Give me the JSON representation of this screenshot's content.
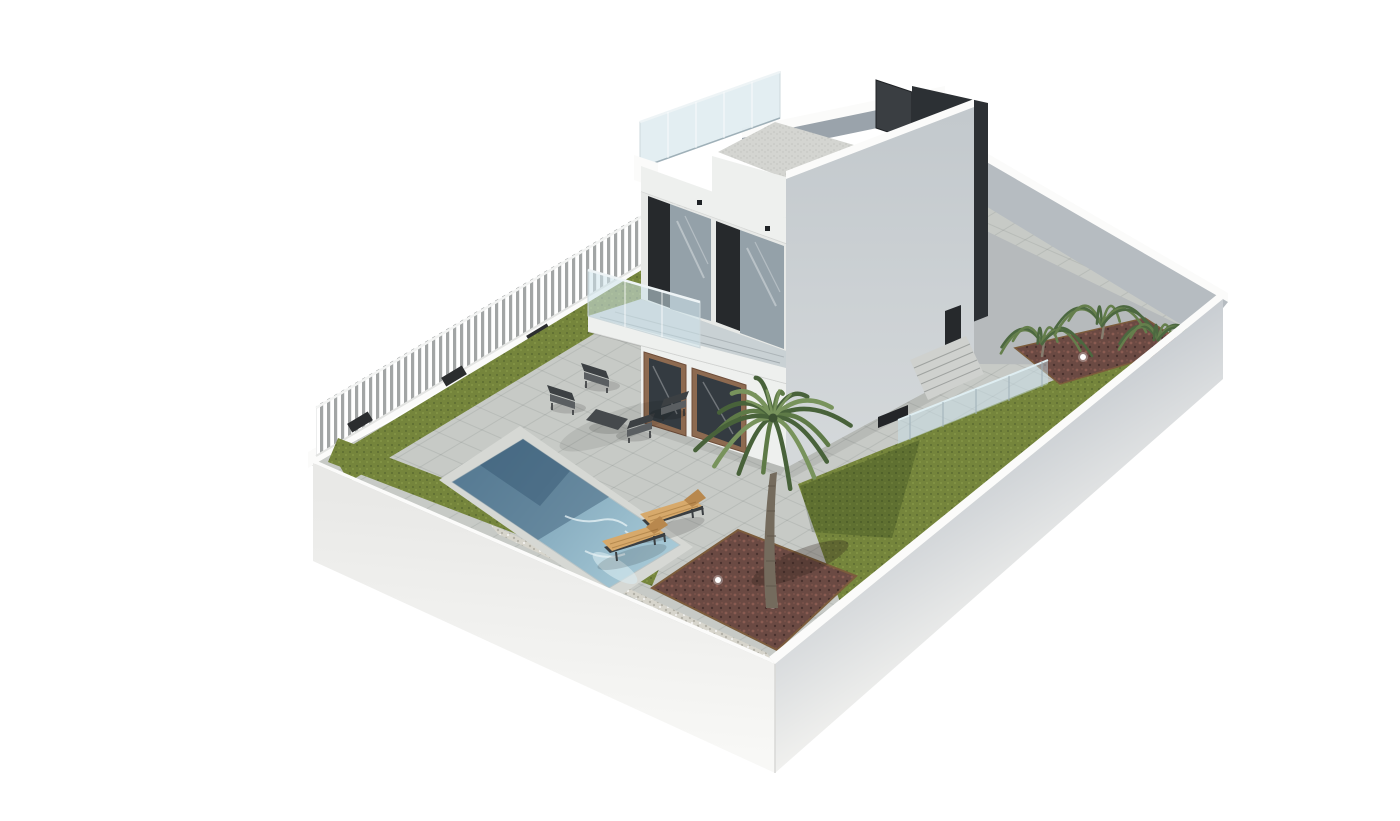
{
  "scene": {
    "title": "3D architectural render of a modern villa plot",
    "description": "Isometric 3D rendering on a white background: a modern two-storey white villa with dark window panels, roof terrace with glass balustrade and dark stair tower, front balcony, walled garden plot with white perimeter walls, slatted fence, olive-green lawns, grey paved terrace, rectangular swimming pool, two wooden sun loungers, dark outdoor lounge set, central palm tree in a red-brown mulch bed, rear shrubs and small garden spotlights.",
    "elements": [
      "perimeter-wall",
      "slat-fence",
      "lawn-strips",
      "right-lawn",
      "paved-terrace",
      "driveway",
      "swimming-pool",
      "pool-coping",
      "sun-loungers",
      "outdoor-sofa-set",
      "coffee-table",
      "villa-building",
      "roof-terrace",
      "glass-balustrade",
      "roof-deck",
      "stair-tower",
      "balcony",
      "balcony-glass-railing",
      "window-units",
      "entrance-doors",
      "exterior-stairs",
      "path-glass-railing",
      "palm-tree",
      "garden-shrubs",
      "mulch-beds",
      "gravel-strip",
      "garden-lights"
    ]
  },
  "palette": {
    "paving": "#c7cac6",
    "pavingLight": "#d6d8d4",
    "tileLine": "rgba(60,70,65,0.10)",
    "drive": "#b6babc",
    "driveLine": "rgba(50,60,60,0.18)",
    "lawn": "#75853c",
    "lawnDark": "#5c6c31",
    "lawnLight": "#8a9b49",
    "mulch": "#6b4a43",
    "mulchDot1": "#8a5c52",
    "mulchDot2": "#4a322e",
    "mulchDot3": "#7a524a",
    "mulchEdge": "#7c5c3c",
    "gravel": "#d7d5cc",
    "gravelDot": "#b4b2a8",
    "poolDeep": "#3f607a",
    "poolMain": "#6f97ae",
    "poolLight": "#a9cbd8",
    "ripple": "#eaf4f7",
    "wallTop": "#fbfbfa",
    "wallInner": "#b6bcc1",
    "wallFaceTop": "#c6cbd0",
    "wallFaceBottom": "#f0f0ee",
    "swTop": "#e9e9e7",
    "swBottom": "#f8f8f6",
    "fenceSlat": "#a2a5a5",
    "houseWhite": "#eef0ee",
    "houseShade": "#e7e9e7",
    "rightTop": "#c3c9cd",
    "rightBottom": "#d5d9db",
    "deck": "#d4d5d1",
    "deckDot": "#c2c3bf",
    "parapetInner": "#9aa3ab",
    "dark": "#2c3034",
    "dark2": "#3a3e42",
    "frameDark": "#26292c",
    "glass": "#94a1a9",
    "glassLight": "#cdd8dc",
    "balGlass": "rgba(205,228,235,0.55)",
    "roofGlass": "rgba(200,222,230,0.5)",
    "wood": "#8d6a50",
    "woodDark": "#6e4d39",
    "lounger": "#d7a96b",
    "loungerDark": "#b8884e",
    "loungerFrame": "#3a3e41",
    "sofa": "#3c4043",
    "sofaCushion": "#5a5e61",
    "palmTrunk": "#746b5d",
    "palmRing": "#5f574c",
    "palmGreen1": "#5e7a47",
    "palmGreen2": "#48623a",
    "palmGreen3": "#78935c",
    "bush": "#4c6840",
    "bush2": "#657f4c",
    "lightDot": "#ffffff"
  }
}
